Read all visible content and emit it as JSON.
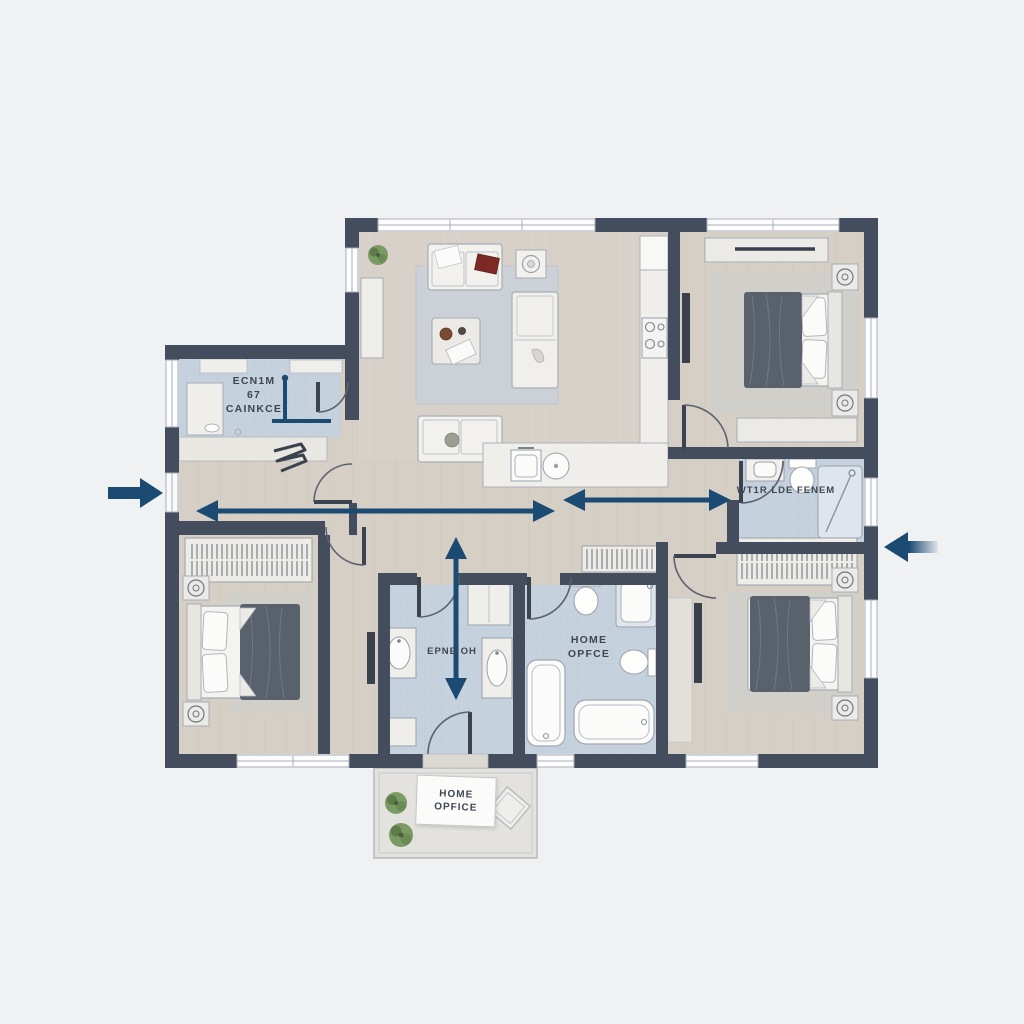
{
  "plan": {
    "utility_room": {
      "line1": "ECN1M",
      "line2": "67",
      "line3": "CAINKCE"
    },
    "wc": {
      "label": "WT1R LDE FENEM"
    },
    "mud_bath": {
      "label": "EPNE OH"
    },
    "bathroom": {
      "line1": "HOME",
      "line2": "OPFCE"
    },
    "patio_sign": {
      "line1": "HOME",
      "line2": "OPFICE"
    }
  },
  "colors": {
    "background": "#f0f1f3",
    "wall": "#434d5d",
    "floor_wood": "#d6cfc6",
    "floor_tile_blue": "#c6d1de",
    "rug": "#ccd1d7",
    "bed_duvet": "#59616d",
    "accent_navy": "#1b4b73",
    "label_text": "#3e4553"
  }
}
